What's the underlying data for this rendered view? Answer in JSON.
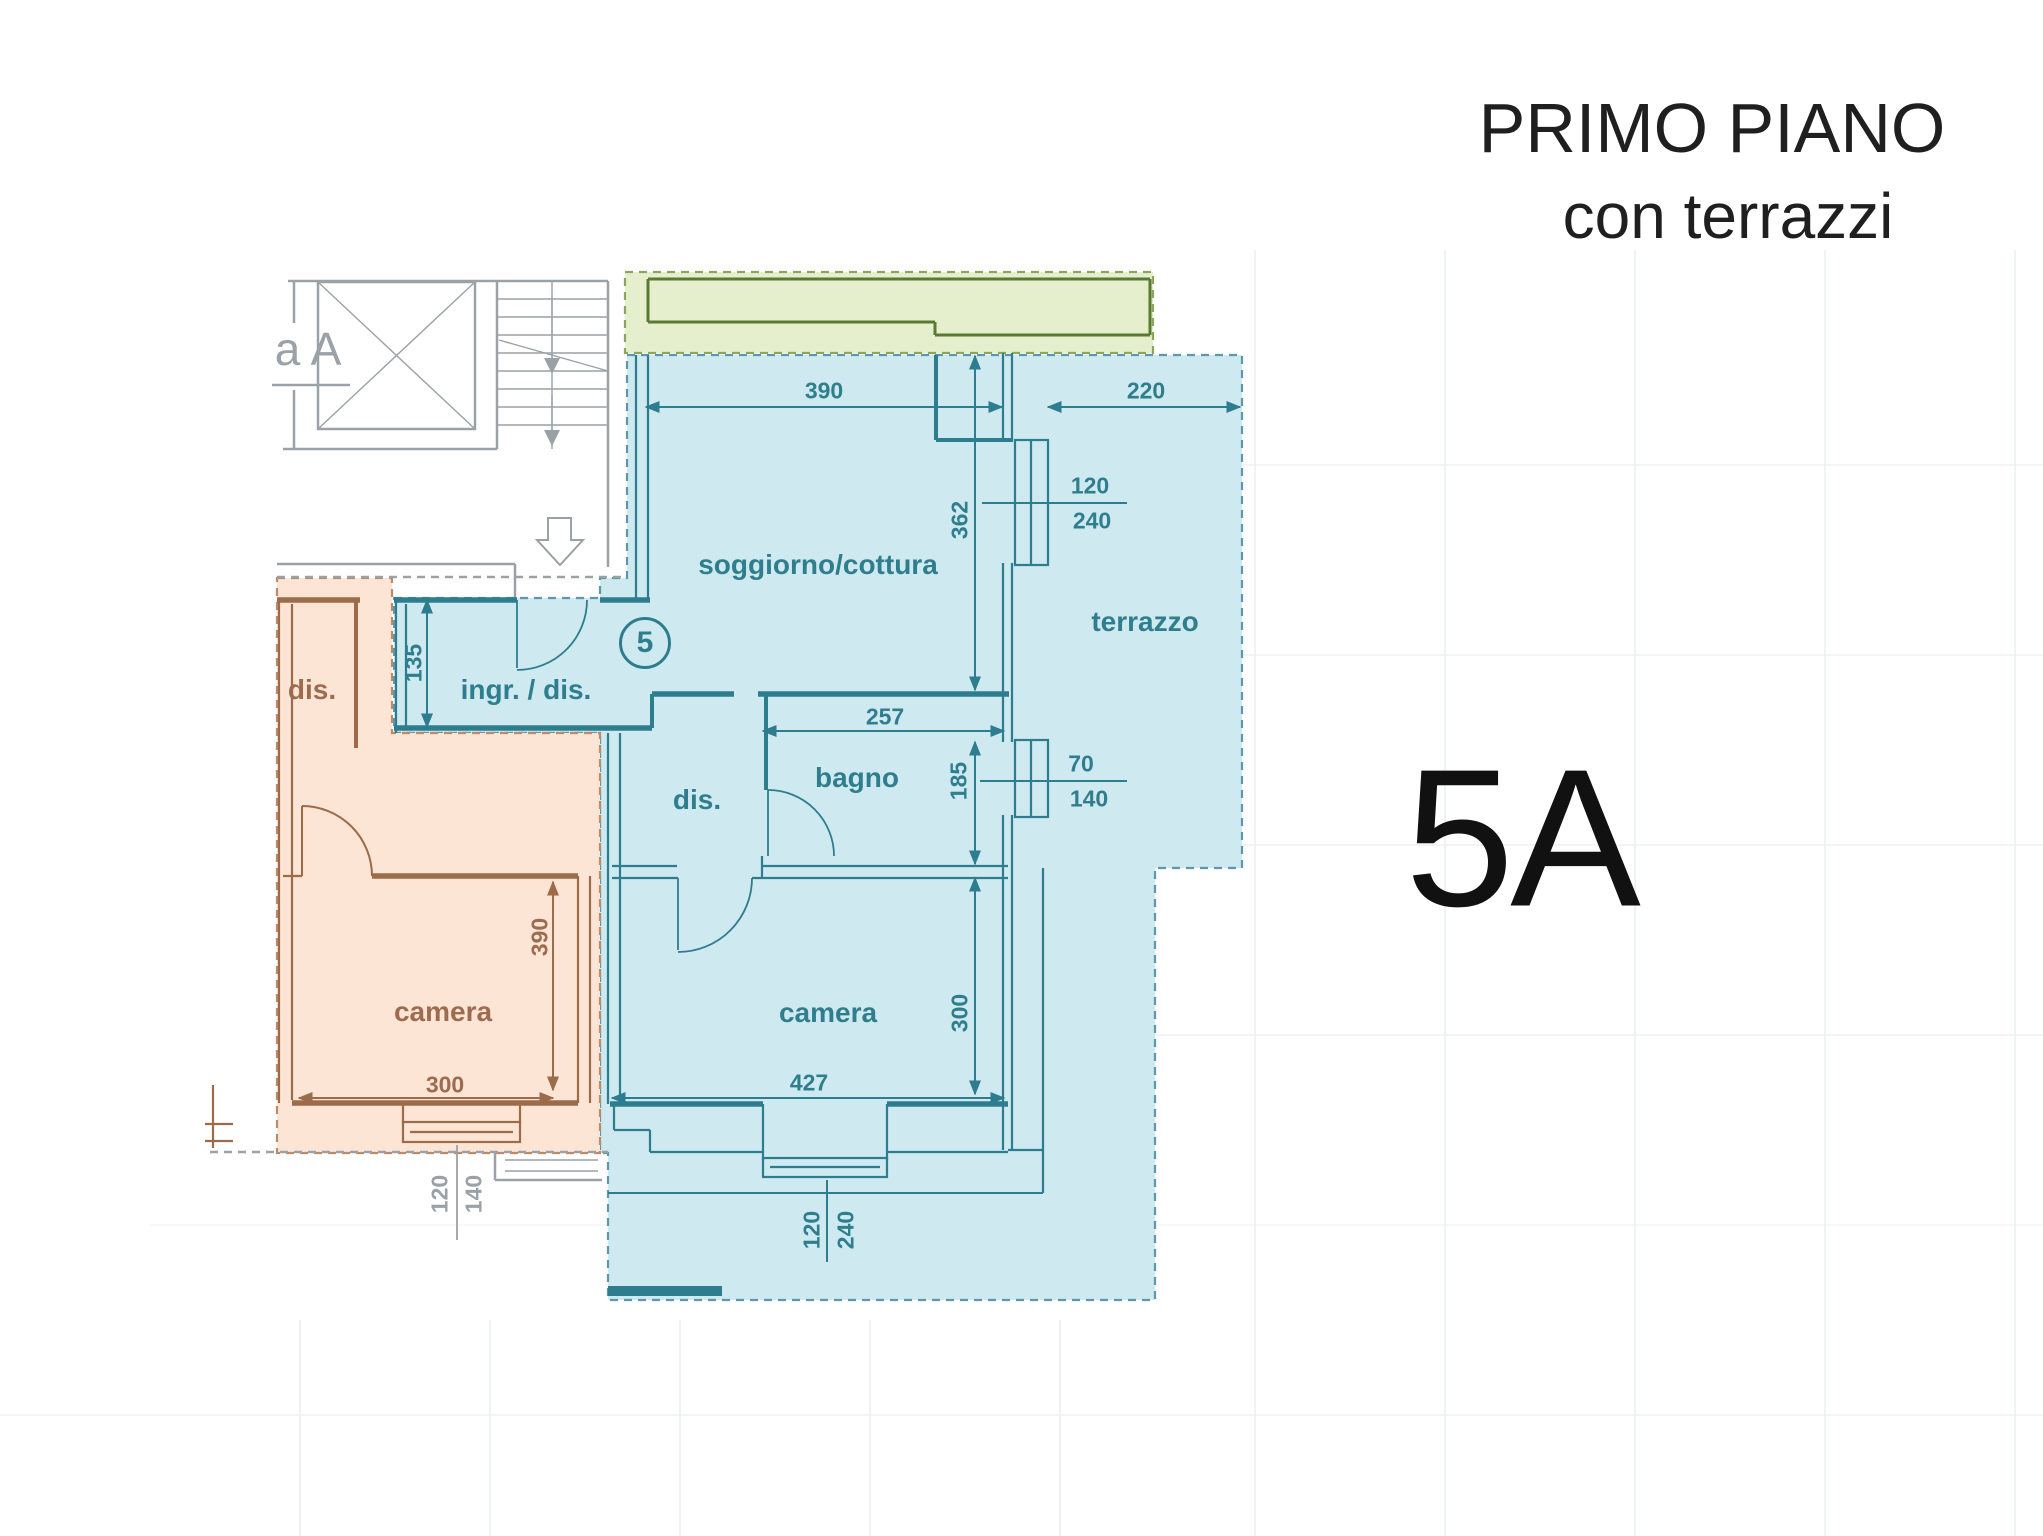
{
  "title": {
    "line1": "PRIMO PIANO",
    "line2": "con terrazzi"
  },
  "unit_big_label": "5A",
  "plan": {
    "stair_label": "a A",
    "blue": {
      "unit_number": "5",
      "rooms": {
        "living": "soggiorno/cottura",
        "entry": "ingr. / dis.",
        "hall": "dis.",
        "bath": "bagno",
        "bedroom": "camera",
        "terrace": "terrazzo"
      },
      "dims": {
        "living_w": "390",
        "terrace_w": "220",
        "win_living_num": "120",
        "win_living_den": "240",
        "living_d": "362",
        "entry_w": "135",
        "bath_w": "257",
        "bath_d": "185",
        "win_bath_num": "70",
        "win_bath_den": "140",
        "bedroom_d": "300",
        "bedroom_w": "427",
        "win_bedroom_num": "120",
        "win_bedroom_den": "240"
      }
    },
    "orange": {
      "rooms": {
        "hall": "dis.",
        "bedroom": "camera"
      },
      "dims": {
        "bedroom_d": "390",
        "bedroom_w": "300",
        "win_num": "120",
        "win_den": "140"
      }
    }
  },
  "colors": {
    "teal": "#2d7d8e",
    "teal_text": "#2f7e8e",
    "blue_fill": "#cfe9f0",
    "blue_dash": "#5b98a8",
    "brown": "#9c6b4a",
    "brown_text": "#9c6b50",
    "orange_fill": "#fce5d4",
    "orange_dash": "#bb8a66",
    "green_line": "#5a7a33",
    "green_fill": "#e5efcd",
    "green_dash": "#8aa65c",
    "gray": "#9aa1a7",
    "grid": "#edf0f2",
    "ink": "#1f1f1f"
  }
}
